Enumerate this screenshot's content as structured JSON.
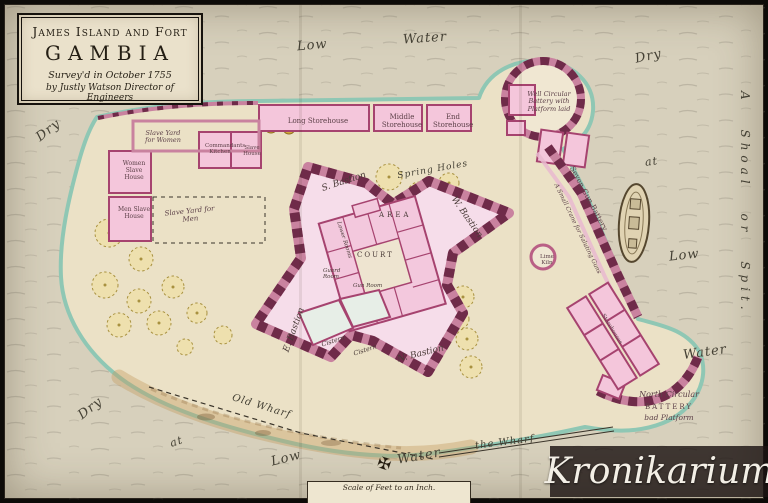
{
  "title_block": {
    "line1": "James Island and Fort",
    "line2": "GAMBIA",
    "line3": "Survey'd in October 1755",
    "line4": "by Justly Watson Director of Engineers"
  },
  "map_labels": {
    "low_top": "Low",
    "water_top": "Water",
    "dry_top_right": "Dry",
    "at_right": "at",
    "low_right": "Low",
    "water_right": "Water",
    "shoal": "A Shoal or Spit.",
    "dry_left": "Dry",
    "dry_bottom": "Dry",
    "at_bottom": "at",
    "low_bottom": "Low",
    "water_bottom": "Water",
    "old_wharf": "Old Wharf",
    "the_wharf": "the Wharf",
    "spring_holes": "Spring Holes"
  },
  "buildings": {
    "long_storehouse": "Long Storehouse",
    "middle_storehouse": "Middle Storehouse",
    "end_storehouse": "End Storehouse",
    "commandants_kitchen": "Commandants Kitchen",
    "slave_house": "Slave House",
    "slave_yard_women": "Slave Yard for Women",
    "women_slave_house": "Women Slave House",
    "men_slave_house": "Men Slave House",
    "slave_yard_men": "Slave Yard for Men",
    "well_circular_battery": "Well Circular Battery with Platform laid",
    "seven_gun_battery": "Seven Gun Battery",
    "small_crane": "A Small Crane for Saluting Guns",
    "lime_kiln": "Lime Kiln",
    "north_battery_line1": "North Circular",
    "north_battery_line2": "BATTERY",
    "north_battery_line3": "bad Platform",
    "storehouses_br": "Storehouses"
  },
  "fort": {
    "s_bastion": "S. Bastion",
    "w_bastion": "W. Bastion",
    "e_bastion": "E. Bastion",
    "n_bastion": "N. Bastion",
    "area": "AREA",
    "court": "COURT",
    "cistern_1": "Cistern",
    "cistern_2": "Cistern",
    "guard_room": "Guard Room",
    "gun_room": "Gun Room",
    "lower_rooms": "Lower Rooms"
  },
  "scale_bar": {
    "label": "Scale of Feet to an Inch."
  },
  "watermark": {
    "text": "Kronikarium"
  },
  "colors": {
    "paper": "#d7d0bc",
    "island": "#ebe1c6",
    "shore_teal": "#8fc7b4",
    "fort_pink": "#f3c8dd",
    "fort_wall_dark": "#6f2b49",
    "fort_wall_light": "#c9829f",
    "accent_magenta": "#a6436f",
    "watermark_band": "#1c1412",
    "sand": "#c29a5e"
  }
}
